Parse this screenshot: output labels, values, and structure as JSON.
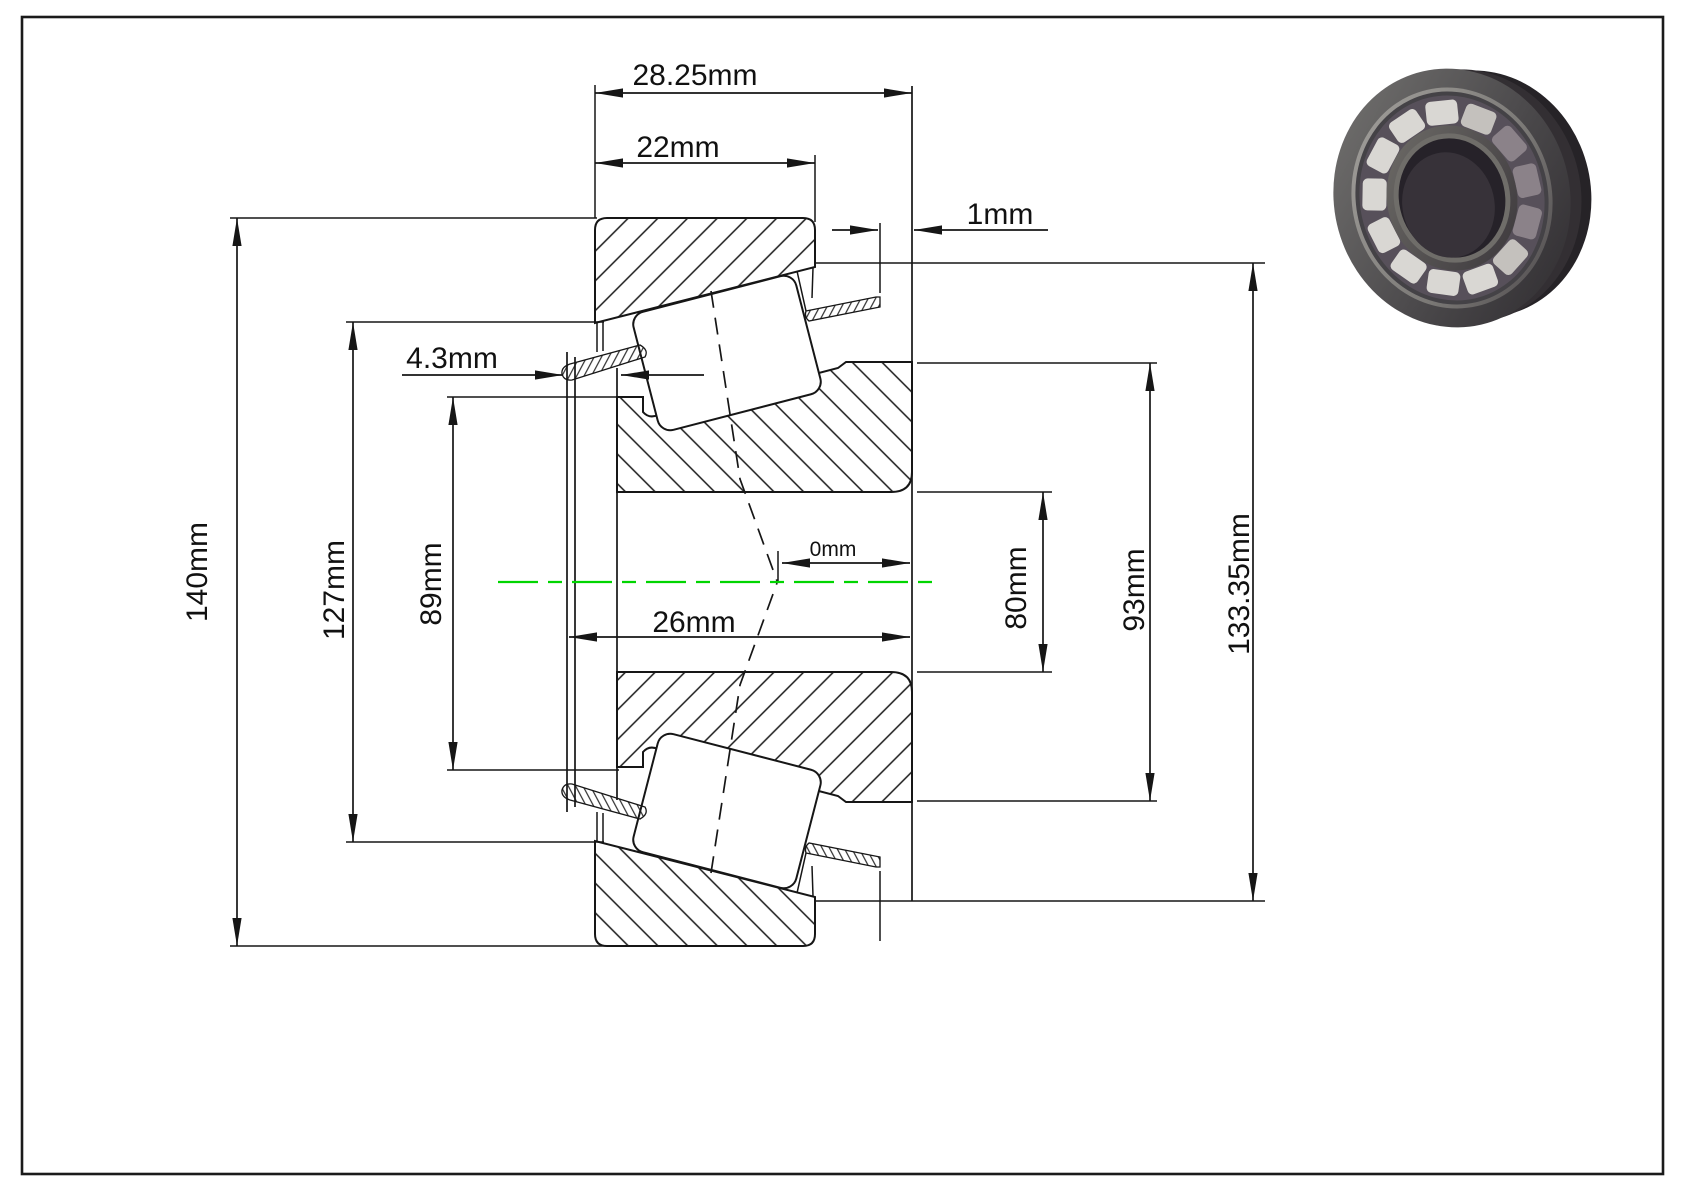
{
  "drawing": {
    "title": "tapered roller bearing cross-section",
    "view": "dimensioned 2D section with 3D render",
    "colors": {
      "line": "#161616",
      "centerline_green": "#00d500",
      "background": "#ffffff",
      "render_ring_dark": "#332f33",
      "render_roller_light": "#d9d7d3"
    }
  },
  "labels": {
    "overall_width": "28.25mm",
    "cup_width": "22mm",
    "cage_stickout": "1mm",
    "flange_offset": "4.3mm",
    "flange_od": "140mm",
    "cup_front_id": "127mm",
    "cone_front_od": "89mm",
    "center_offset": "0mm",
    "cone_width": "26mm",
    "bore_diameter": "80mm",
    "cone_rib_od": "93mm",
    "cup_od": "133.35mm"
  }
}
